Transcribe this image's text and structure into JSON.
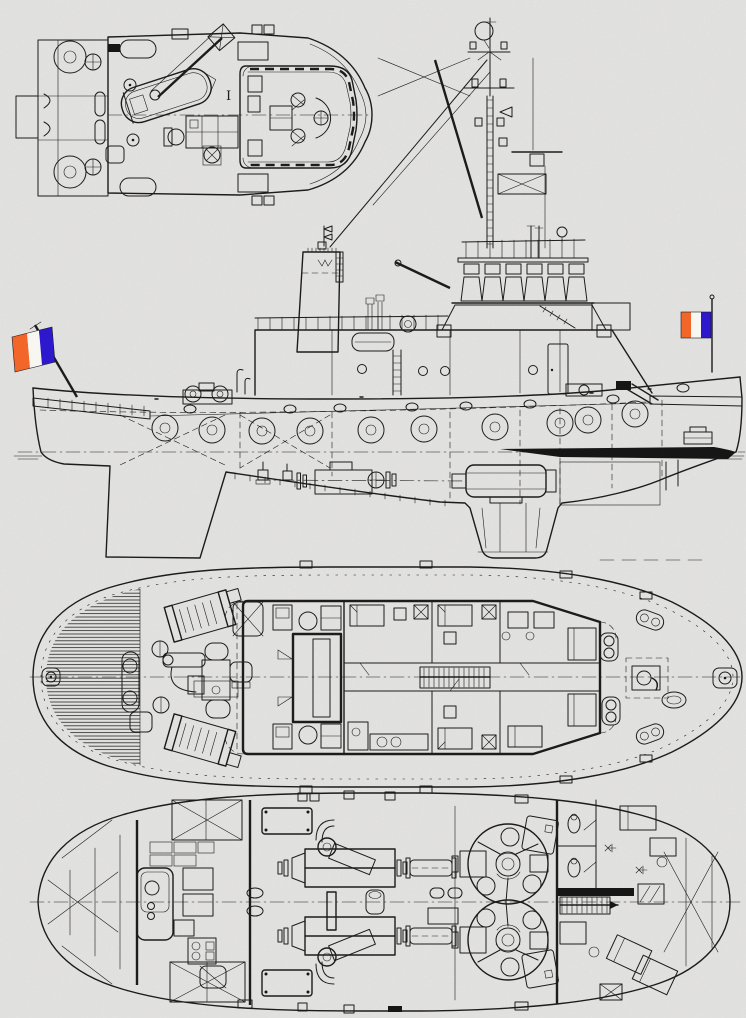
{
  "document": {
    "kind": "naval-architecture general arrangement drawing",
    "subject": "harbour tugboat, four views (boat-deck plan, outboard profile, main-deck plan, lower-deck plan)",
    "paper_color": "#efeeec",
    "ink_color": "#1c1c1c",
    "waterline_stripe_color": "#141414"
  },
  "flags": {
    "kind": "french-tricolour-ensign",
    "stripes": [
      "#f2662a",
      "#f8f6f1",
      "#2d18cd"
    ],
    "locations": [
      "bow-jackstaff",
      "stern-ensign-staff"
    ]
  },
  "boat_deck_plan": {
    "marking": "I"
  }
}
